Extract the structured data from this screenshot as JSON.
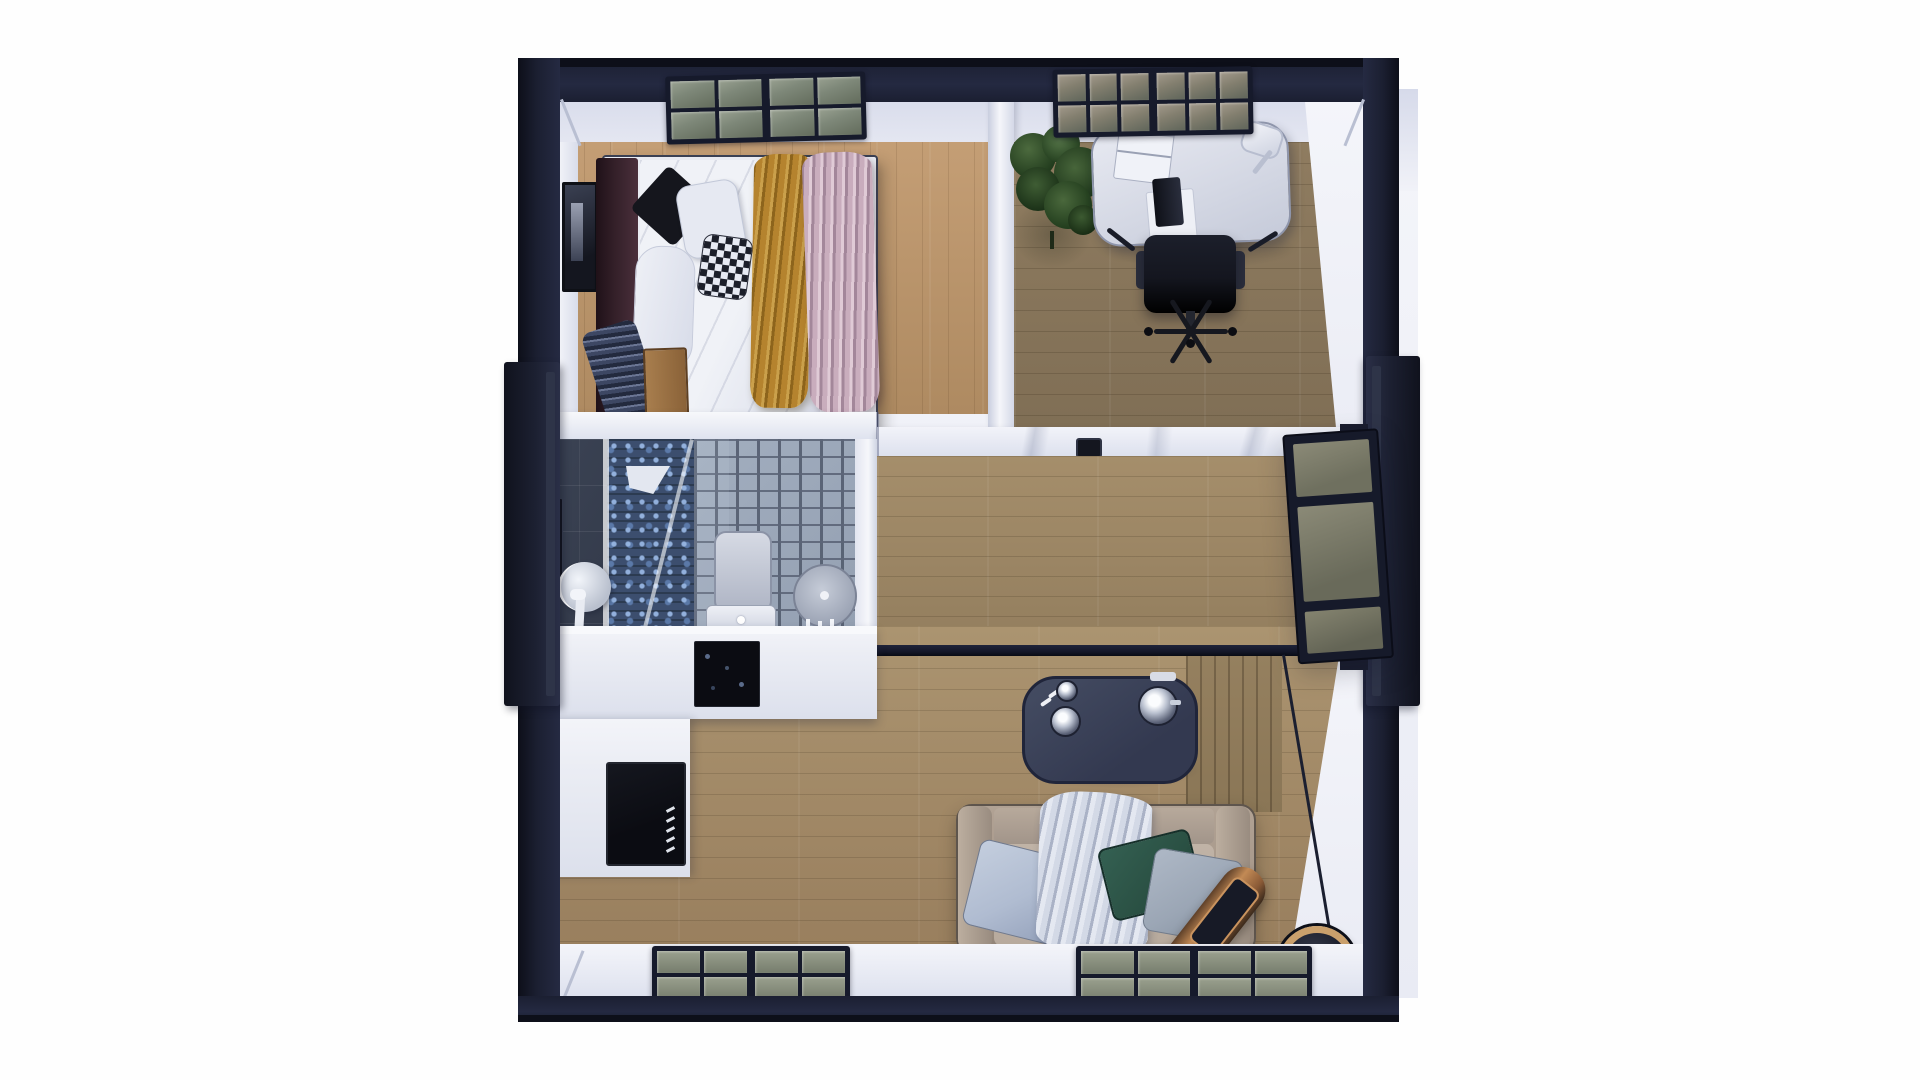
{
  "scene": {
    "title": "Top-down 3D floor plan render of a small two-module home",
    "background": "#ffffff",
    "view": "orthographic top view, photorealistic miniature"
  },
  "palette": {
    "wall_outer": "#1b1f31",
    "wall_outer_dark": "#0d0f19",
    "wall_face": "#e9ebf4",
    "wall_face_bright": "#f4f5fa",
    "wall_shadow": "#c9cede",
    "floor_bedroom": "#c49e75",
    "floor_bedroom_dark": "#ae8a61",
    "floor_office": "#8f7c60",
    "floor_office_dark": "#7d6c53",
    "floor_hall": "#a58e6b",
    "floor_hall_dark": "#937e5e",
    "floor_living": "#ab9470",
    "floor_living_dark": "#997f5e",
    "wood_wall": "#8a7656",
    "window_frame": "#161a2b",
    "pane_green": "#7e8879",
    "pane_green_dark": "#636c5c",
    "bath_slate": "#333a4a",
    "mosaic_blue": "#7fa3d3",
    "mosaic_base": "#22334f",
    "brick_light": "#94a0b2",
    "brick_dark": "#5c6578",
    "white_goods": "#ebedf4",
    "appliance": "#0b0c12",
    "headboard": "#342029",
    "duvet": "#e9ebf2",
    "pillow_black": "#15161d",
    "blanket_mustard": "#b5832e",
    "blanket_pink": "#c9adbd",
    "blanket_navy": "#3d4763",
    "bench_wood": "#a87e4e",
    "desk": "#dce0ea",
    "chair": "#14161f",
    "plant": "#35522c",
    "table": "#394057",
    "chrome": "#dfe3ec",
    "sofa": "#a69789",
    "sofa_seat": "#b7aa9d",
    "pillow_blue": "#b0bcd1",
    "pillow_green": "#2a5043",
    "pillow_gray": "#9ba6b5",
    "throw_white": "#d3d9e6",
    "copper": "#c28a55",
    "copper_dark": "#171a26",
    "door_glass": "#85846f",
    "divider": "#141728"
  },
  "rooms": [
    {
      "id": "bedroom",
      "position": "top-left",
      "contents": [
        "double-bed",
        "dark-headboard",
        "black-pillow",
        "white-pillows",
        "checkered-pillow",
        "mustard-throw",
        "pink-throw",
        "navy-foot-throw",
        "wood-bench",
        "wall-art",
        "ceiling-window"
      ]
    },
    {
      "id": "home-office",
      "position": "top-right",
      "contents": [
        "white-desk",
        "laptop",
        "desk-lamp",
        "black-office-chair",
        "potted-plant",
        "ceiling-window"
      ]
    },
    {
      "id": "bathroom",
      "position": "middle-left",
      "contents": [
        "slate-tile-wall",
        "blue-mosaic-shower",
        "glass-shower-screen",
        "shower-head",
        "stone-brick-wall",
        "toilet",
        "round-sink",
        "round-mirror",
        "faucet",
        "control-panel"
      ]
    },
    {
      "id": "kitchen",
      "position": "lower-left",
      "contents": [
        "l-shaped-white-counter",
        "black-cooktop-panel",
        "black-oven"
      ]
    },
    {
      "id": "hallway",
      "position": "middle",
      "contents": [
        "wood-floor",
        "marble-top-partition",
        "door-handle"
      ]
    },
    {
      "id": "living-room",
      "position": "bottom",
      "contents": [
        "taupe-sofa",
        "light-blue-pillow",
        "green-pillow",
        "gray-pillow",
        "white-throw-blanket",
        "navy-coffee-table",
        "chrome-kettle",
        "chrome-cup",
        "copper-cylinder-lamp",
        "wood-feature-wall",
        "floor-windows"
      ]
    }
  ],
  "openings": {
    "top_windows": 2,
    "bottom_floor_windows": 2,
    "left_side": "protruding-door-frame",
    "right_side": "open-glass-door-with-frame"
  }
}
